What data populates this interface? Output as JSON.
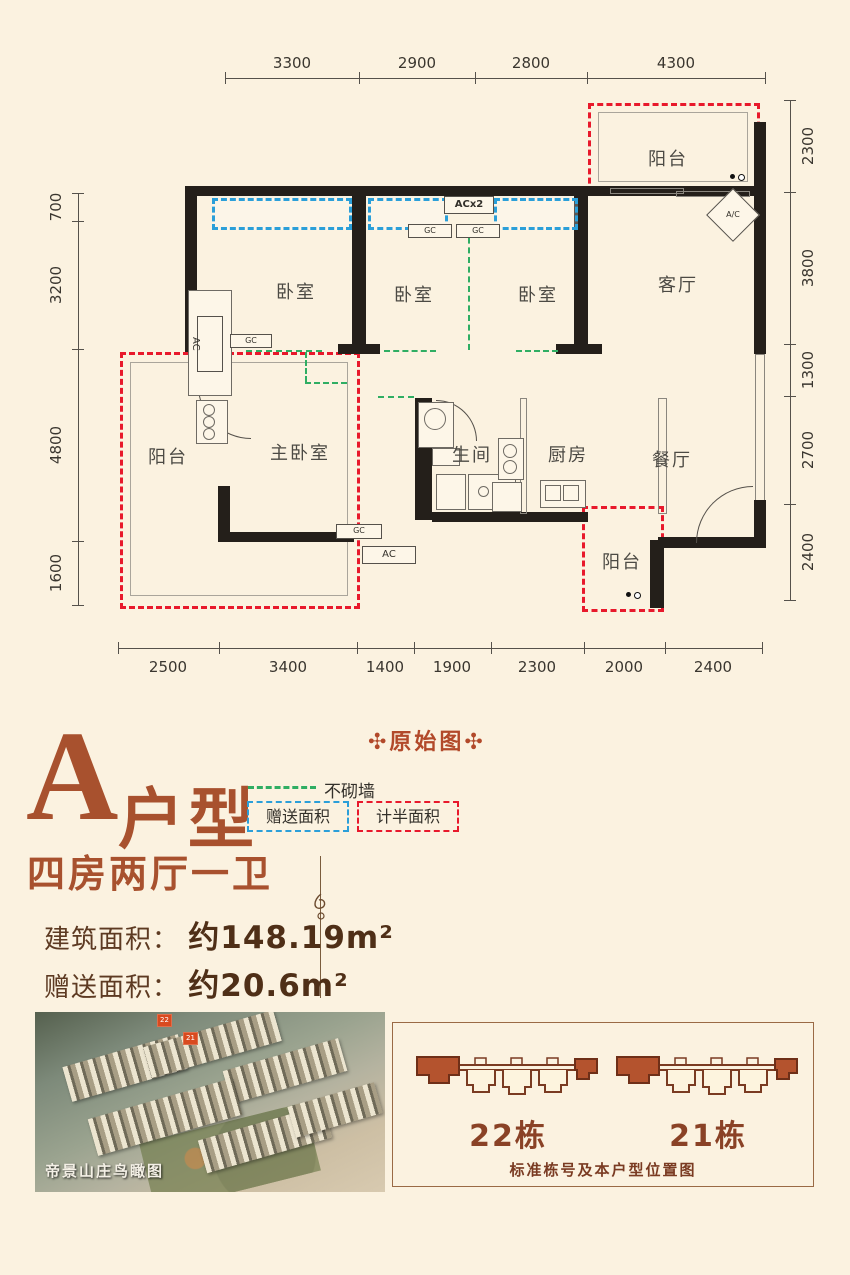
{
  "colors": {
    "background": "#fbf2e0",
    "wall": "#241f1a",
    "accent_brown": "#a8512e",
    "deep_brown": "#4f2f17",
    "red_dash": "#e8192c",
    "blue_dash": "#2b9fd9",
    "green_dash": "#2fae63"
  },
  "fp": {
    "rooms": {
      "balcony_tr": "阳台",
      "bed1": "卧室",
      "bed2": "卧室",
      "bed3": "卧室",
      "living": "客厅",
      "balcony_left": "阳台",
      "master": "主卧室",
      "bath": "生间",
      "kitchen": "厨房",
      "dining": "餐厅",
      "balcony_bottom": "阳台"
    },
    "tags": {
      "acx2": "ACx2",
      "gc": "GC",
      "ac": "AC",
      "ac_diamond": "A/C"
    },
    "dim": {
      "top": [
        3300,
        2900,
        2800,
        4300
      ],
      "left": [
        700,
        3200,
        4800,
        1600
      ],
      "right": [
        2300,
        3800,
        1300,
        2700,
        2400
      ],
      "bottom": [
        2500,
        3400,
        1400,
        1900,
        2300,
        2000,
        2400
      ]
    }
  },
  "header": {
    "original_label": "✣原始图✣",
    "type_letter": "A",
    "type_word": "户型",
    "layout": "四房两厅一卫"
  },
  "legend": {
    "no_wall": "不砌墙",
    "gift_area": "赠送面积",
    "half_area": "计半面积"
  },
  "areas": {
    "build_label": "建筑面积：",
    "build_value": "约148.19m²",
    "gift_label": "赠送面积：",
    "gift_value": "约20.6m²"
  },
  "photo": {
    "caption": "帝景山庄鸟瞰图",
    "marker22": "22",
    "marker21": "21"
  },
  "panel": {
    "building22": "22栋",
    "building21": "21栋",
    "caption": "标准栋号及本户型位置图"
  }
}
